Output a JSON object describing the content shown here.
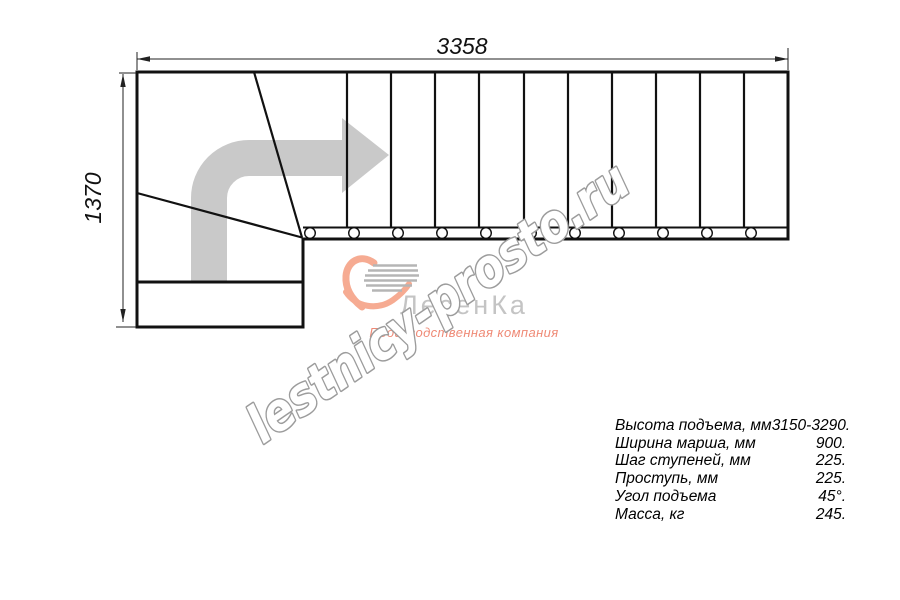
{
  "drawing": {
    "width_dim": "3358",
    "height_dim": "1370",
    "line_color": "#111111",
    "dim_color": "#222222",
    "arrow_color": "#c9c9c9"
  },
  "watermark": {
    "text": "lestnicy-prosto.ru",
    "fill": "#ffffff",
    "outline": "#9c9c9c"
  },
  "logo": {
    "brand": "ЛесенКа",
    "subtitle": "Производственная компания",
    "heart_color": "#f6ab92",
    "speed_lines_color": "#b5b5b5",
    "brand_color": "#c4c4c4",
    "subtitle_color": "#ef8a76"
  },
  "specs": {
    "rows": [
      {
        "label": "Высота подъема, мм",
        "value": "3150-3290."
      },
      {
        "label": "Ширина марша, мм",
        "value": "900."
      },
      {
        "label": "Шаг ступеней, мм",
        "value": "225."
      },
      {
        "label": "Проступь, мм",
        "value": "225."
      },
      {
        "label": "Угол подъема",
        "value": "45°."
      },
      {
        "label": "Масса, кг",
        "value": "245."
      }
    ]
  }
}
